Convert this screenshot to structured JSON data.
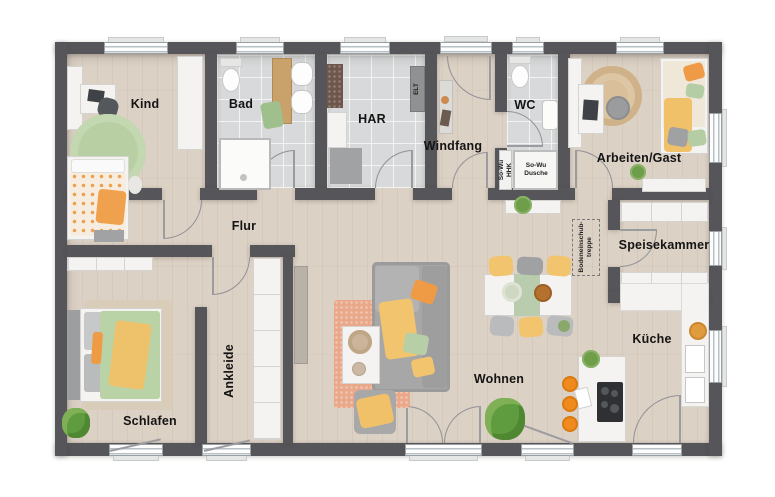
{
  "labels": {
    "kind": "Kind",
    "bad": "Bad",
    "har": "HAR",
    "windfang": "Windfang",
    "wc": "WC",
    "arbeiten": "Arbeiten/Gast",
    "flur": "Flur",
    "speisekammer": "Speisekammer",
    "schlafen": "Schlafen",
    "ankleide": "Ankleide",
    "wohnen": "Wohnen",
    "kueche": "Küche"
  },
  "tech": {
    "elt": "ELT",
    "sowu_hhk_line1": "So-Wu",
    "sowu_hhk_line2": "HHK",
    "dusche_line1": "So-Wu",
    "dusche_line2": "Dusche",
    "treppe_line1": "Bodeneinschub-",
    "treppe_line2": "treppe"
  },
  "palette": {
    "wall": "#56565A",
    "wood_floor": "#DCD1C5",
    "tile_floor": "#D7D9DA",
    "accent_orange": "#F09A47",
    "accent_yellow": "#F1C46C",
    "accent_green": "#B5CFA4",
    "rug_terracotta": "#E9A88A",
    "furniture_white": "#F4F3F1",
    "furniture_gray": "#9FA1A3"
  }
}
